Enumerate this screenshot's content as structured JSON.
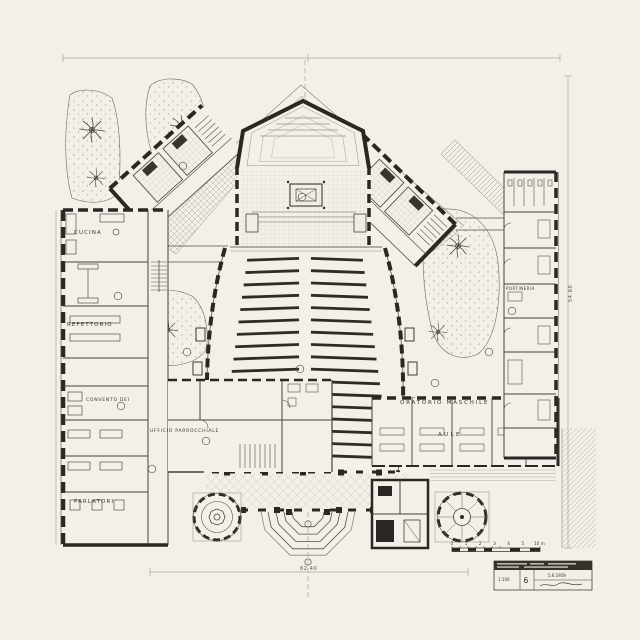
{
  "plan": {
    "labels": {
      "cucina": "CUCINA",
      "refettorio": "REFETTORIO",
      "convento": "CONVENTO DEI",
      "parlatori": "PARLATORI",
      "ufficio": "UFFICIO PARROCCHIALE",
      "oratorio": "ORATORIO MASCHILE",
      "aule": "AULE",
      "portineria": "PORTINERIA"
    },
    "dimensions": {
      "front_width": "62.40",
      "side_height": "54.60"
    },
    "scale_bar": {
      "numbers": "0 1 2 3 4 5",
      "end": "10 m"
    },
    "title_block": {
      "scale": "1:100",
      "sheet": "6",
      "date": "5.6.1959"
    },
    "colors": {
      "paper": "#f2f0e9",
      "ink": "#2b2722",
      "hatch": "#a9a49a"
    }
  }
}
